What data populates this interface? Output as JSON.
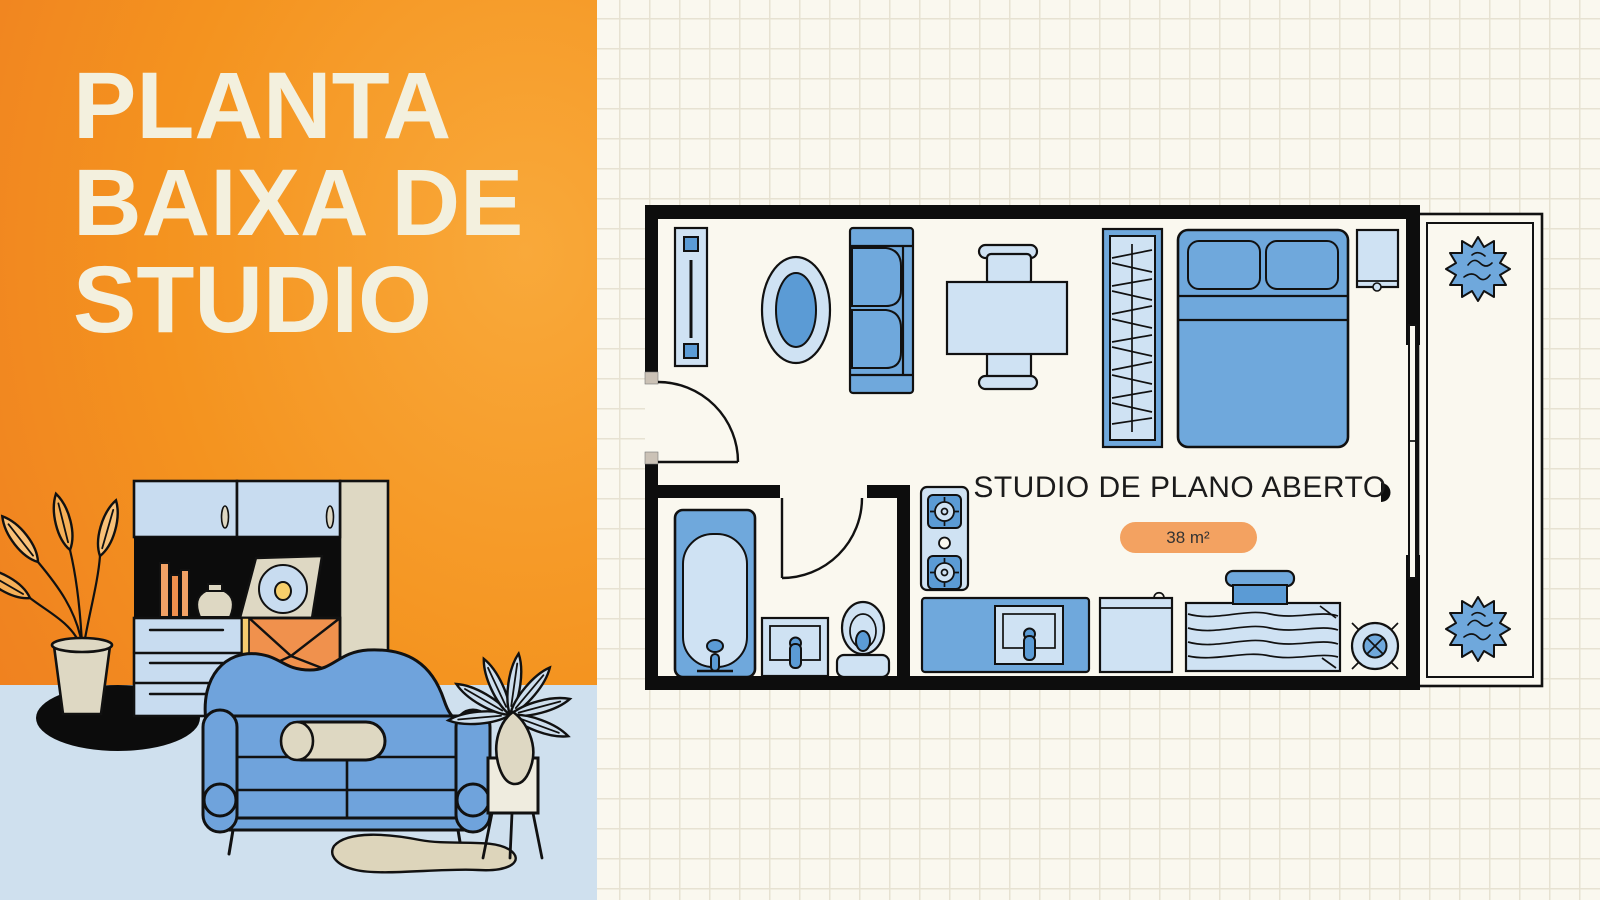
{
  "poster": {
    "title_lines": [
      "PLANTA",
      "BAIXA DE",
      "STUDIO"
    ],
    "plan": {
      "label": "STUDIO DE PLANO ABERTO",
      "area": "38 m²"
    }
  },
  "colors": {
    "panel_orange_light": "#f9a93a",
    "panel_orange_dark": "#ee7a15",
    "title_text": "#f3f0de",
    "paper": "#faf8ef",
    "grid_line": "#e7e2d2",
    "wall_black": "#0d0d0d",
    "furniture_blue": "#6fa8dc",
    "furniture_light_blue": "#cfe2f3",
    "furniture_dark_blue": "#5b9bd5",
    "badge_fill": "#f3a261",
    "floor_blue": "#cfe0ee",
    "cream": "#ded8c3"
  },
  "floor_plan": {
    "furniture": [
      "wall-console",
      "oval-rug",
      "sofa",
      "dining-table",
      "dining-chair-top",
      "dining-chair-bottom",
      "wardrobe",
      "double-bed",
      "nightstand",
      "bathtub",
      "bathroom-sink",
      "toilet",
      "stove",
      "kitchen-sink-counter",
      "fridge",
      "wood-counter",
      "round-stool",
      "entry-door",
      "bathroom-door",
      "sliding-balcony-door",
      "balcony",
      "balcony-plant-top",
      "balcony-plant-bottom",
      "door-handle"
    ]
  },
  "illustration": {
    "items": [
      "floor",
      "shadow",
      "bookshelf-cabinet",
      "cabinet-doors",
      "open-shelf",
      "books",
      "vase",
      "vinyl-record",
      "drawers",
      "envelope-door",
      "potted-plant",
      "sofa",
      "bolster-cushion",
      "rug",
      "houseplant",
      "plant-vase",
      "side-table"
    ]
  }
}
